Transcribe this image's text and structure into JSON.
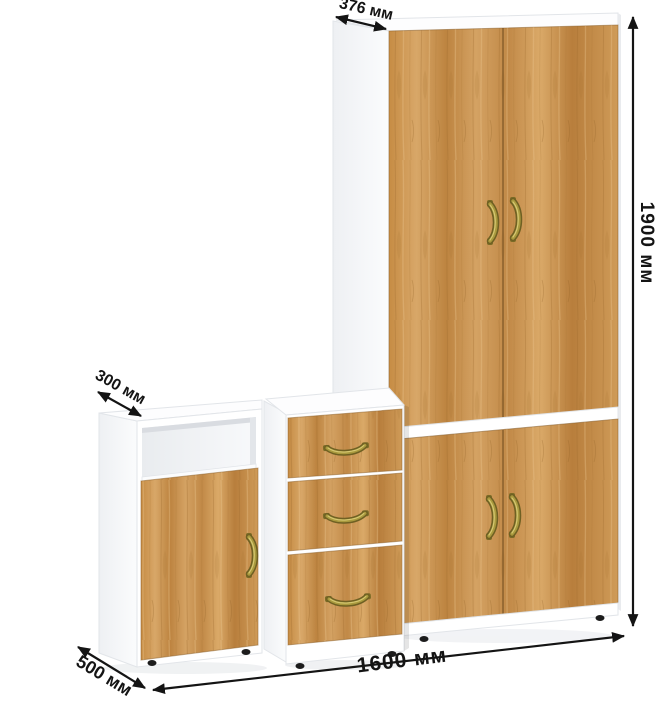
{
  "annotations": {
    "wardrobe_depth": "376 мм",
    "total_height": "1900 мм",
    "shelf_cabinet_depth": "300 мм",
    "drawer_unit_depth": "500 мм",
    "total_width": "1600 мм"
  },
  "palette": {
    "background": "#ffffff",
    "carcass_white": "#ffffff",
    "wood_light": "#d9a766",
    "wood_mid": "#c68c44",
    "wood_dark": "#a9732f",
    "handle_brass": "#a99a3e",
    "dimension_ink": "#141414"
  },
  "furniture": {
    "pieces": [
      "tall two-door wardrobe with upper and lower doors",
      "three-drawer unit",
      "open-shelf cabinet with single door"
    ]
  }
}
